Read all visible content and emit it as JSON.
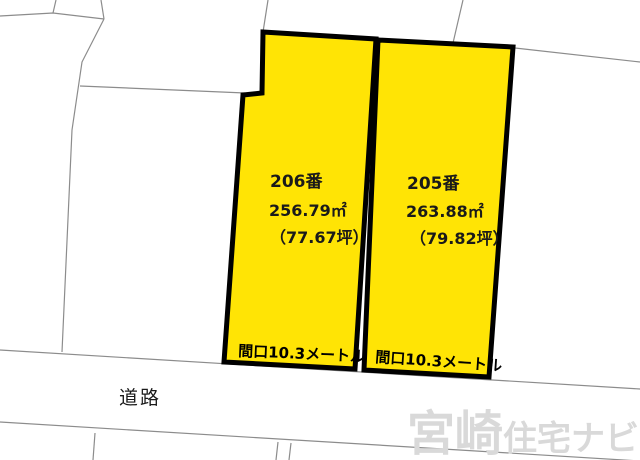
{
  "map": {
    "background_color": "#ffffff",
    "parcel_line_color": "#8c8c8c",
    "plot_border_color": "#000000",
    "plot_fill_color": "#ffe405",
    "plot_text_color": "#1a1a1a",
    "plots": [
      {
        "parcel_number": "206番",
        "area_sqm": "256.79㎡",
        "area_tsubo": "（77.67坪）",
        "frontage": "間口10.3メートル",
        "fill": "#ffe405"
      },
      {
        "parcel_number": "205番",
        "area_sqm": "263.88㎡",
        "area_tsubo": "（79.82坪）",
        "frontage": "間口10.3メートル",
        "fill": "#ffe405"
      }
    ],
    "road_label": "道路",
    "watermark": {
      "part1": "宮崎",
      "part2": "住宅ナビ",
      "color": "#d9d9d9"
    }
  }
}
